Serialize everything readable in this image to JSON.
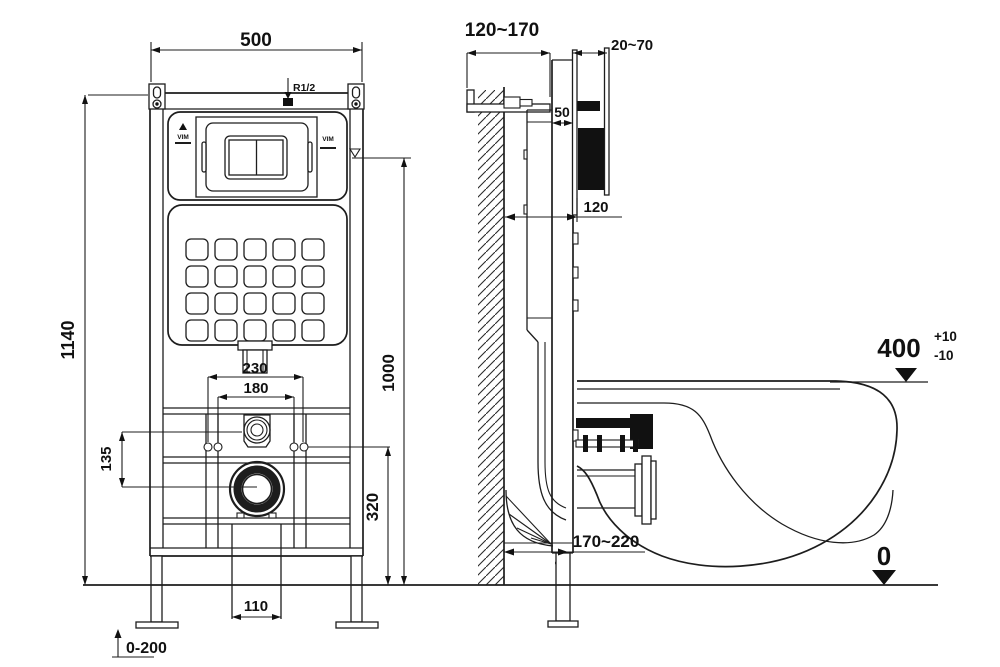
{
  "drawing": {
    "front": {
      "dim_width": "500",
      "dim_height": "1140",
      "dim_bolt_outer": "230",
      "dim_bolt_inner": "180",
      "dim_inlet_offset": "135",
      "dim_flush_height": "1000",
      "dim_drain_height": "320",
      "dim_outlet_width": "110",
      "dim_foot_adjust": "0-200",
      "label_supply": "R1/2",
      "label_brand_left": "VIM",
      "label_brand_right": "VIM"
    },
    "side": {
      "dim_wall_offset": "120~170",
      "dim_plate_depth": "20~70",
      "dim_rail_depth": "50",
      "dim_frame_depth": "120",
      "dim_seat_height": "400",
      "dim_seat_tol_plus": "+10",
      "dim_seat_tol_minus": "-10",
      "dim_drain_reach": "170~220",
      "dim_floor": "0"
    },
    "colors": {
      "line": "#1d1d1d",
      "background": "#ffffff"
    }
  }
}
